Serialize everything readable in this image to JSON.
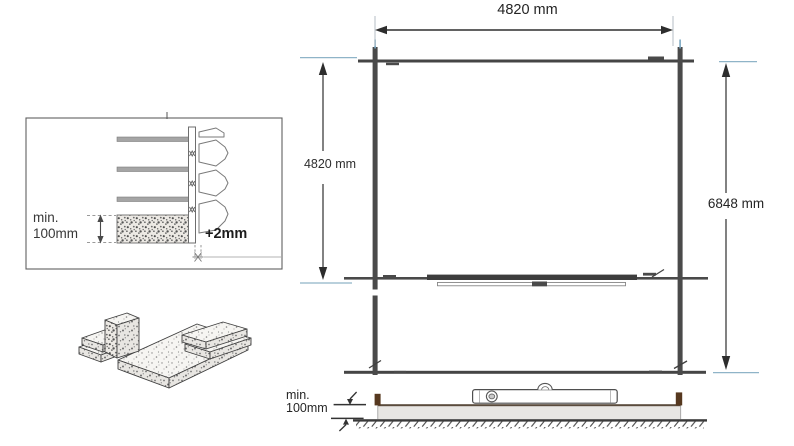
{
  "labels": {
    "plan_top_width": "4820 mm",
    "plan_left_height": "4820 mm",
    "plan_right_height": "6848 mm",
    "inset_min_line1": "min.",
    "inset_min_line2": "100mm",
    "inset_offset": "+2mm",
    "section_min_line1": "min.",
    "section_min_line2": "100mm"
  },
  "colors": {
    "background": "#ffffff",
    "line_dark": "#3f3f3f",
    "log_gray": "#a5a5a5",
    "extension_blue": "#8fb4c8",
    "wood_brown": "#56381f",
    "slab_fill": "#e8e6e3"
  },
  "drawings": {
    "inset_detail": "wall-corner-foundation-detail",
    "slab_illustration": "paving-slabs-isometric",
    "floor_plan": "foundation-beam-plan",
    "ground_section": "foundation-ground-section-with-spirit-level"
  }
}
